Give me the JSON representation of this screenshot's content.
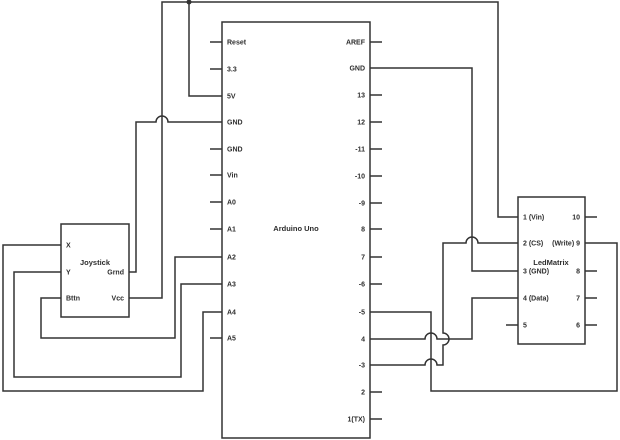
{
  "diagram": {
    "colors": {
      "line": "#333333",
      "background": "#ffffff",
      "text": "#2d2d2d"
    },
    "components": [
      {
        "name": "arduino",
        "title": "Arduino Uno",
        "left_pins": [
          "Reset",
          "3.3",
          "5V",
          "GND",
          "GND",
          "Vin",
          "A0",
          "A1",
          "A2",
          "A3",
          "A4",
          "A5"
        ],
        "right_pins": [
          "AREF",
          "GND",
          "13",
          "12",
          "-11",
          "-10",
          "-9",
          "8",
          "7",
          "-6",
          "-5",
          "4",
          "-3",
          "2",
          "1(TX)"
        ]
      },
      {
        "name": "joystick",
        "title": "Joystick",
        "left_pins": [
          "X",
          "Y",
          "Bttn"
        ],
        "right_pins": [
          "Grnd",
          "Vcc"
        ]
      },
      {
        "name": "ledmatrix",
        "title": "LedMatrix",
        "left_pins": [
          "1 (Vin)",
          "2 (CS)",
          "3 (GND)",
          "4 (Data)",
          "5"
        ],
        "right_pins": [
          "10",
          "(Write) 9",
          "8",
          "7",
          "6"
        ]
      }
    ],
    "nets": [
      {
        "pins": [
          "Arduino.5V",
          "Joystick.Vcc",
          "LedMatrix.1 (Vin)"
        ]
      },
      {
        "pins": [
          "Arduino.GND (left)",
          "Joystick.Grnd"
        ]
      },
      {
        "pins": [
          "Arduino.A2",
          "Joystick.Bttn"
        ]
      },
      {
        "pins": [
          "Arduino.A3",
          "Joystick.Y"
        ]
      },
      {
        "pins": [
          "Arduino.A4",
          "Joystick.X"
        ]
      },
      {
        "pins": [
          "Arduino.GND (right)",
          "LedMatrix.3 (GND)"
        ]
      },
      {
        "pins": [
          "Arduino.-3",
          "LedMatrix.2 (CS)"
        ]
      },
      {
        "pins": [
          "Arduino.4",
          "LedMatrix.4 (Data)"
        ]
      },
      {
        "pins": [
          "Arduino.-5",
          "LedMatrix.(Write) 9"
        ]
      }
    ]
  }
}
